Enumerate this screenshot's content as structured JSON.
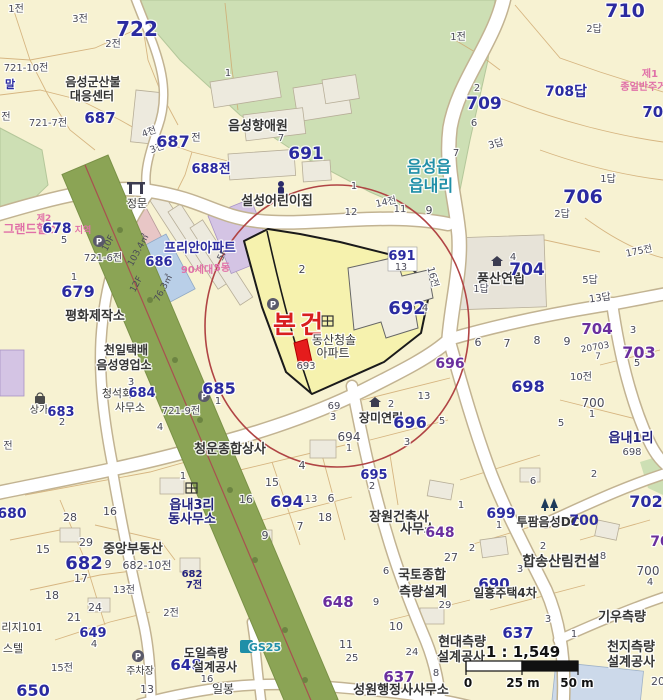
{
  "map": {
    "title": "cadastral-map-eumseong",
    "colors": {
      "accent_red": "#d81f1f",
      "circle_red": "#b04444",
      "parcel_navy": "#2b2ba0",
      "poi_purple": "#6a2f9e",
      "teal": "#1f8fa8",
      "zone_pink": "#e070a8",
      "base_cream": "#f7f2d2",
      "forest_green": "#cddfb4",
      "band_olive": "#8ba455",
      "highlight_yellow": "#f6f2ae"
    },
    "scale": {
      "ratio": "1 : 1,549",
      "tick0": "0",
      "tick25": "25 m",
      "tick50": "50 m"
    },
    "labels": {
      "a1": "1전",
      "a2": "3전",
      "a3": "722",
      "a4": "2전",
      "a5": "721-10전",
      "a6": "말",
      "a7": "음성군산불",
      "a8": "대응센터",
      "a9": "687",
      "a10": "721-7전",
      "a11": "전",
      "a12": "4전",
      "a13": "3전",
      "a14": "687",
      "a15": "전",
      "a16": "688전",
      "a17": "1",
      "a18": "음성향애원",
      "a19": "7",
      "a20": "691",
      "a21": "1전",
      "a22": "710",
      "a23": "2답",
      "a24": "708답",
      "a25": "제1",
      "a26": "종일반주거지",
      "a27": "707",
      "a28": "709",
      "a29": "2",
      "a30": "6",
      "a31": "7",
      "a32": "3답",
      "a33": "706",
      "a34": "1답",
      "a35": "2답",
      "a36": "음성읍",
      "a37": "읍내리",
      "a38": "14전",
      "a39": "11",
      "a40": "9",
      "a41": "설성어린이집",
      "a42": "1",
      "a43": "12",
      "b1": "정문",
      "b2": "그랜드헬스",
      "b3": "제2",
      "b4": "지역",
      "b5": "678",
      "b6": "5",
      "b7": "프리안아파트",
      "b8": "90세대",
      "b9": "5동",
      "b10": "686",
      "b11": "103.4㎡",
      "b12": "76.3㎡",
      "b13": "10F",
      "b14": "12F",
      "b15": "5F",
      "b16": "679",
      "b17": "1",
      "b18": "평화제작소",
      "b19": "721-6전",
      "b20": "691",
      "b21": "13",
      "b22": "2",
      "b23": "본건",
      "b24": "692",
      "b25": "동산청솔",
      "b26": "아파트",
      "b27": "693",
      "b28": "16전",
      "b29": "4",
      "b30": "풍산연립",
      "b31": "4",
      "b32": "704",
      "b33": "1답",
      "b34": "5답",
      "b35": "13답",
      "b36": "175전",
      "b37": "698",
      "b38": "696",
      "b39": "6",
      "b40": "7",
      "b41": "8",
      "b42": "9",
      "b43": "704",
      "b44": "20703",
      "b45": "7",
      "b46": "703",
      "b47": "3",
      "b48": "5",
      "b49": "10전",
      "b50": "700",
      "b51": "1",
      "b52": "5",
      "b53": "읍내1리",
      "b54": "698",
      "b55": "685",
      "b56": "1",
      "b57": "721-9전",
      "b58": "4",
      "b59": "천일택배",
      "b60": "음성영업소",
      "b61": "3",
      "b62": "청석회",
      "b63": "684",
      "b64": "사무소",
      "b65": "상가",
      "b66": "683",
      "b67": "2",
      "b68": "전",
      "b69": "청운종합상사",
      "b70": "69",
      "b71": "3",
      "b72": "장미연립",
      "b73": "2",
      "b74": "696",
      "b75": "13",
      "b76": "5",
      "b77": "694",
      "b78": "1",
      "b79": "3",
      "b80": "695",
      "b81": "2",
      "c1": "읍내3리",
      "c2": "동사무소",
      "c3": "1",
      "c4": "680",
      "c5": "28",
      "c6": "16",
      "c7": "15",
      "c8": "29",
      "c9": "682",
      "c10": "9",
      "c11": "중앙부동산",
      "c12": "682-10전",
      "c13": "17",
      "c14": "18",
      "c15": "13전",
      "c16": "24",
      "c17": "21",
      "c18": "682",
      "c19": "7전",
      "c20": "2전",
      "c21": "리지101",
      "c22": "스텔",
      "c23": "649",
      "c24": "4",
      "c25": "15전",
      "c26": "650",
      "c27": "주차장",
      "c28": "도일측량",
      "c29": "648",
      "c30": "설계공사",
      "c31": "16",
      "c32": "13",
      "c33": "일봉",
      "c34": "GS25",
      "c35": "4",
      "c36": "15",
      "c37": "16",
      "c38": "694",
      "c39": "13",
      "c40": "6",
      "c41": "18",
      "c42": "7",
      "c43": "9",
      "c44": "장원건축사",
      "c45": "사무소",
      "c46": "648",
      "c47": "699",
      "c48": "1",
      "c49": "1",
      "c50": "2",
      "c51": "6",
      "c52": "27",
      "c53": "2",
      "c54": "2",
      "c55": "투팜음성DC",
      "c56": "700",
      "c57": "702",
      "c58": "70",
      "c59": "합송산림컨설",
      "c60": "8",
      "c61": "3",
      "c62": "국토종합",
      "c63": "측량설계",
      "c64": "9",
      "c65": "6",
      "c66": "29",
      "c67": "648",
      "c68": "690",
      "c69": "일흥주택4차",
      "c70": "637",
      "c71": "3",
      "c72": "1",
      "c73": "기우측량",
      "c74": "700",
      "c75": "4",
      "c76": "637",
      "c77": "8",
      "c78": "24",
      "c79": "10",
      "c80": "11",
      "c81": "25",
      "c82": "현대측량",
      "c83": "설계공사",
      "c88": "천지측량",
      "c89": "설계공사",
      "c90": "성원행정사사무소",
      "c91": "20"
    }
  }
}
